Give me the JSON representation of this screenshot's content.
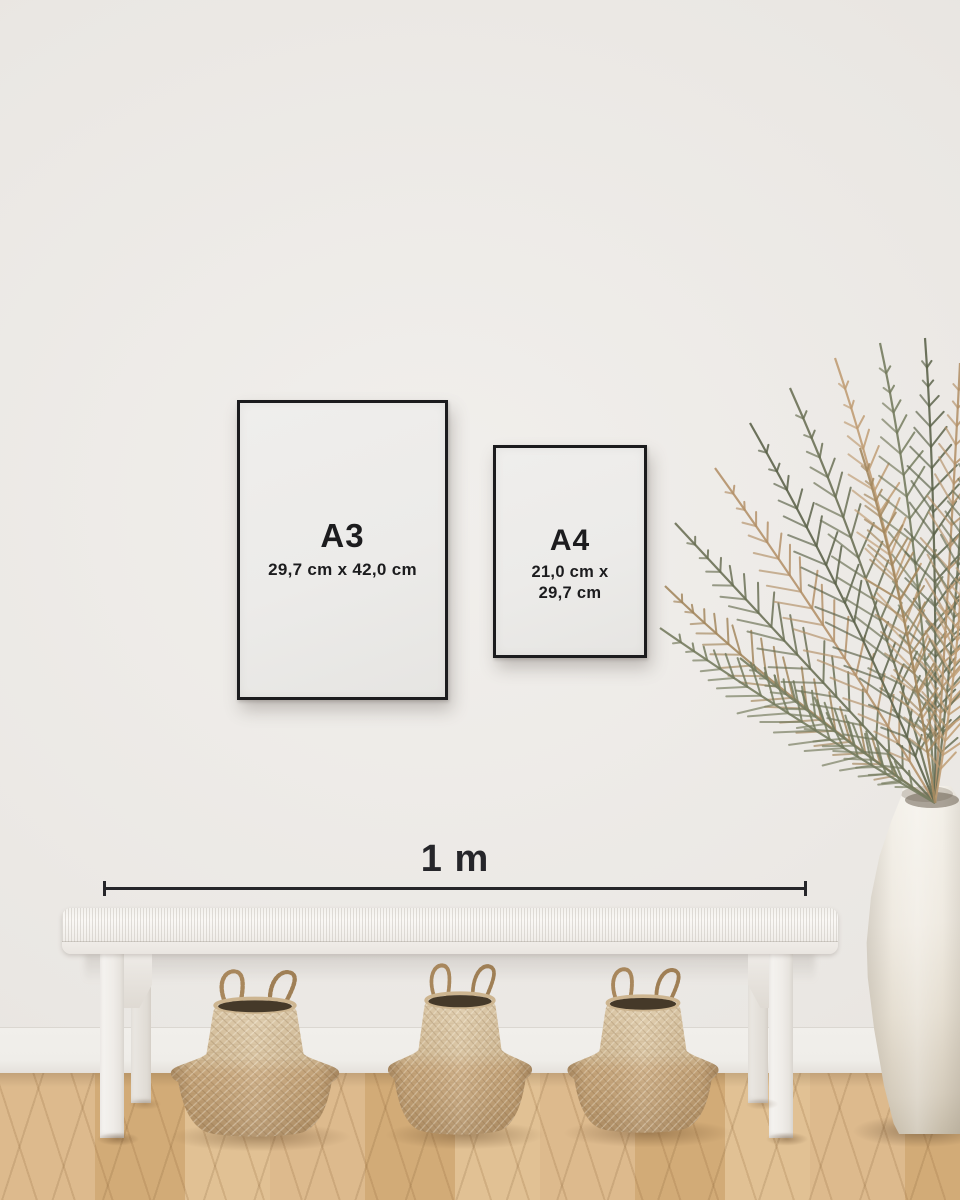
{
  "posters": [
    {
      "id": "a3",
      "size_label": "A3",
      "dimensions": "29,7 cm x 42,0 cm"
    },
    {
      "id": "a4",
      "size_label": "A4",
      "dimensions_lines": [
        "21,0 cm x",
        "29,7 cm"
      ]
    }
  ],
  "scale_bar": {
    "label": "1 m"
  },
  "objects": {
    "plant": "dried-palm-plant",
    "vase": "white-ceramic-floor-vase",
    "bench": "white-woven-bench",
    "baskets": "seagrass-belly-baskets",
    "basket_count": 3,
    "floor": "light-oak-wood-floor",
    "wall": "white-wall"
  },
  "colors": {
    "frame": "#1b1b1d",
    "poster": "#ecebe9",
    "text": "#1c1c1e",
    "scale_line": "#26262a",
    "wall": "#e9e6e2",
    "bench": "#f5f3ef",
    "basket_light": "#dfccab",
    "basket_mid": "#c9a87d",
    "basket_dark": "#ae8d63",
    "basket_interior": "#453929",
    "floor_light": "#e1c194",
    "floor_mid": "#d2ab77",
    "floor_dark": "#b98f62",
    "vase": "#efeae1",
    "plant_green": "#6b7156",
    "plant_tan": "#b4926a"
  }
}
